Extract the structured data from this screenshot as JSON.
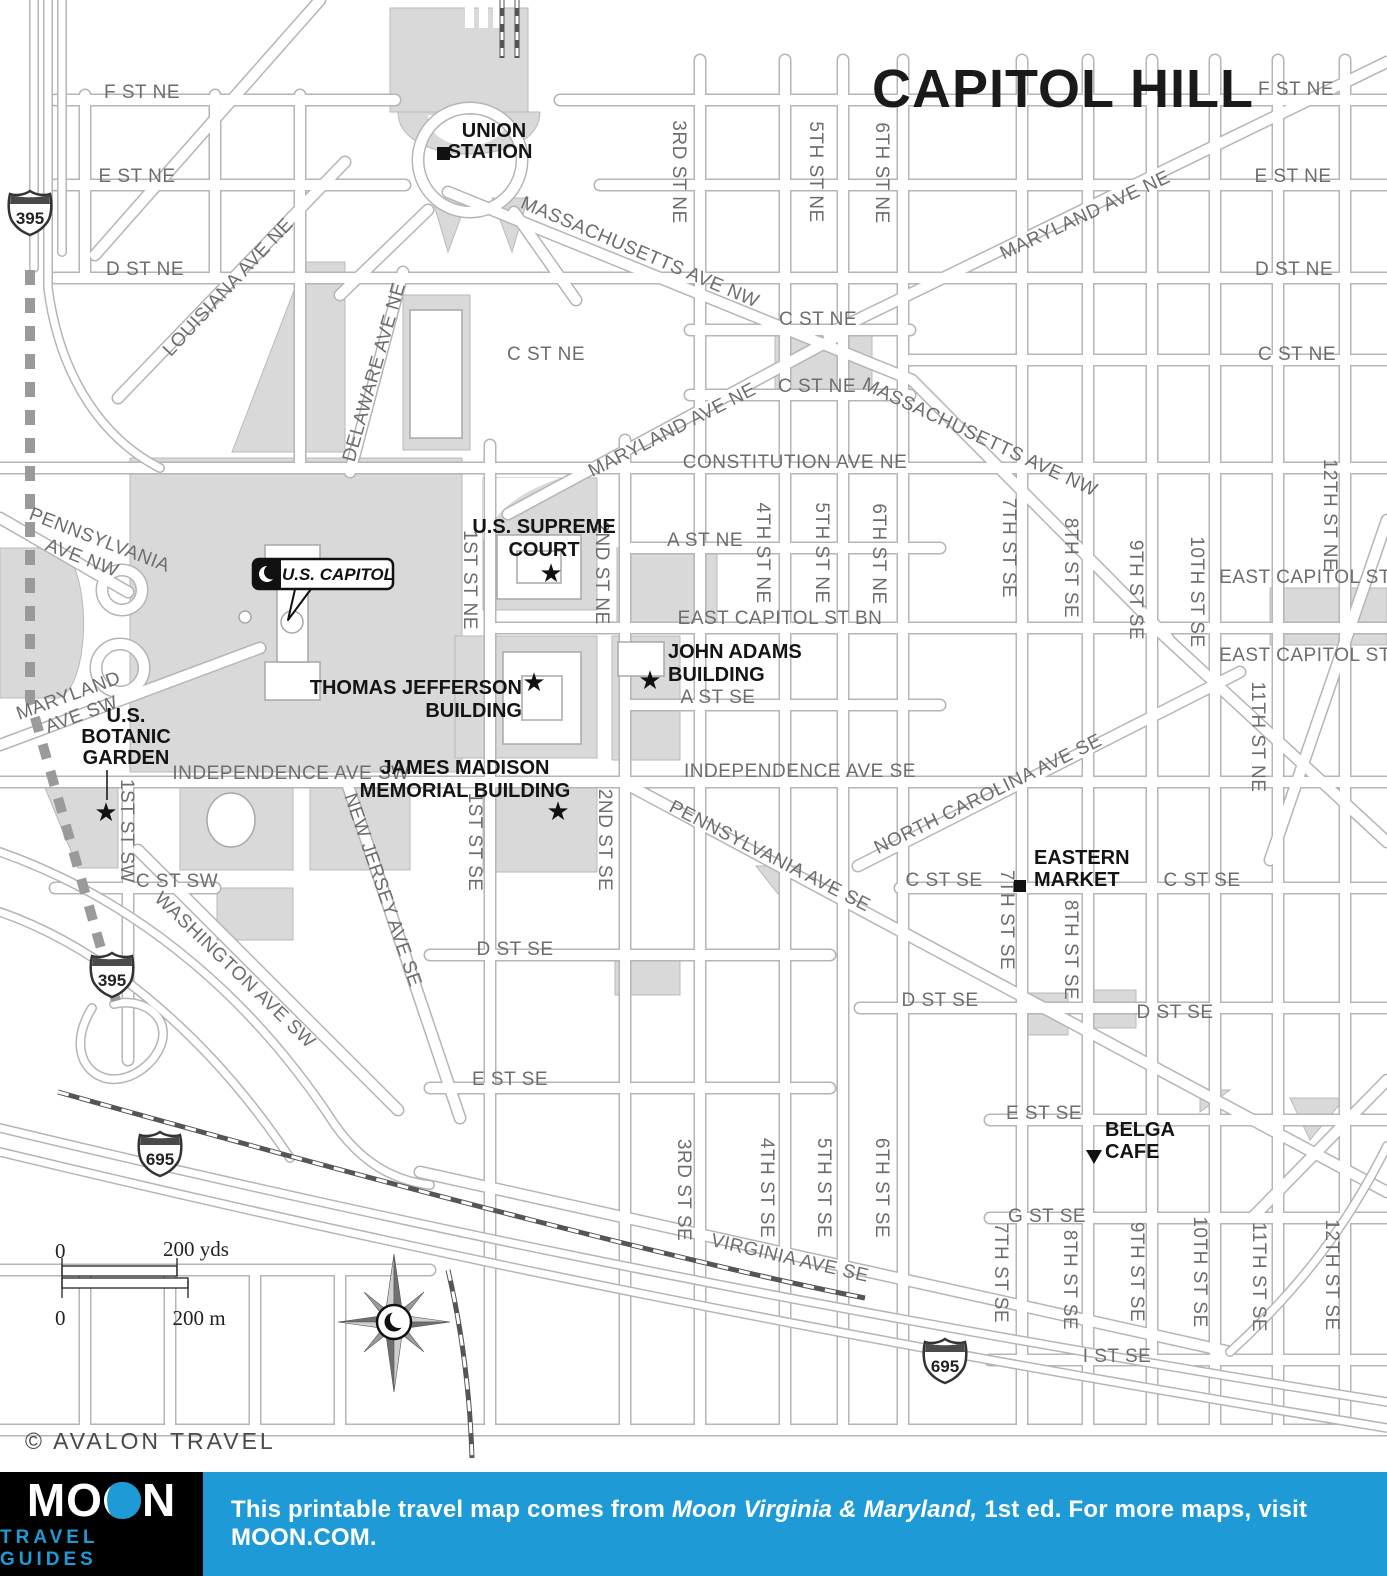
{
  "title": "CAPITOL HILL",
  "copyright": "© AVALON TRAVEL",
  "colors": {
    "accent_blue": "#1e9ad6",
    "park_gray": "#d9d9d9",
    "road_casing_gray": "#b5b5b5",
    "street_label_gray": "#6d6d6d",
    "poi_black": "#141414"
  },
  "map": {
    "icons": {
      "star": "★"
    },
    "streets": {
      "f_st_ne": "F ST NE",
      "e_st_ne": "E ST NE",
      "d_st_ne": "D ST NE",
      "c_st_ne": "C ST NE",
      "constitution_ave_ne": "CONSTITUTION AVE NE",
      "a_st_ne": "A ST NE",
      "east_capitol_st_bn": "EAST CAPITOL ST BN",
      "east_capitol_st": "EAST CAPITOL ST",
      "a_st_se": "A ST SE",
      "independence_ave_sw": "INDEPENDENCE AVE SW",
      "independence_ave_se": "INDEPENDENCE AVE SE",
      "c_st_sw": "C ST SW",
      "c_st_se": "C ST SE",
      "d_st_se": "D ST SE",
      "e_st_se": "E ST SE",
      "g_st_se": "G ST SE",
      "i_st_se": "I ST SE",
      "massachusetts_ave_nw": "MASSACHUSETTS AVE NW",
      "maryland_ave_ne": "MARYLAND AVE NE",
      "maryland_sw_l1": "MARYLAND",
      "maryland_sw_l2": "AVE SW",
      "pennsylvania_l1": "PENNSYLVANIA",
      "pennsylvania_l2": "AVE NW",
      "pennsylvania_ave_se": "PENNSYLVANIA AVE SE",
      "north_carolina_ave_se": "NORTH CAROLINA AVE SE",
      "new_jersey_ave_se": "NEW JERSEY AVE SE",
      "washington_ave_sw": "WASHINGTON AVE SW",
      "louisiana_ave_ne": "LOUISIANA AVE NE",
      "delaware_ave_ne": "DELAWARE AVE NE",
      "virginia_ave_se": "VIRGINIA AVE SE",
      "st_1_ne": "1ST ST NE",
      "st_1_sw": "1ST ST SW",
      "st_1_se": "1ST ST SE",
      "st_2_ne": "2ND ST NE",
      "st_2_se": "2ND ST SE",
      "st_3_ne": "3RD ST NE",
      "st_3_se": "3RD ST SE",
      "st_4_ne": "4TH ST NE",
      "st_4_se": "4TH ST SE",
      "st_5_ne": "5TH ST NE",
      "st_5_se": "5TH ST SE",
      "st_6_ne": "6TH ST NE",
      "st_6_se": "6TH ST SE",
      "st_7_se": "7TH ST SE",
      "st_8_se": "8TH ST SE",
      "st_9_se": "9TH ST SE",
      "st_10_se": "10TH ST SE",
      "st_11_ne": "11TH ST NE",
      "st_11_se": "11TH ST SE",
      "st_12_ne": "12TH ST NE",
      "st_12_se": "12TH ST SE"
    },
    "pois": {
      "union_l1": "UNION",
      "union_l2": "STATION",
      "supreme_l1": "U.S. SUPREME",
      "supreme_l2": "COURT",
      "us_capitol": "U.S. CAPITOL",
      "jefferson_l1": "THOMAS JEFFERSON",
      "jefferson_l2": "BUILDING",
      "adams_l1": "JOHN ADAMS",
      "adams_l2": "BUILDING",
      "madison_l1": "JAMES MADISON",
      "madison_l2": "MEMORIAL BUILDING",
      "botanic_l1": "U.S.",
      "botanic_l2": "BOTANIC",
      "botanic_l3": "GARDEN",
      "eastern_l1": "EASTERN",
      "eastern_l2": "MARKET",
      "belga_l1": "BELGA",
      "belga_l2": "CAFE"
    },
    "shields": {
      "i395": "395",
      "i695": "695"
    },
    "scale": {
      "zero": "0",
      "yds_label": "200 yds",
      "m_label": "200 m"
    }
  },
  "footer": {
    "logo": {
      "m1": "MO",
      "m2": "N",
      "subtitle": "TRAVEL GUIDES"
    },
    "note_pre": "This printable travel map comes from ",
    "note_book": "Moon Virginia & Maryland,",
    "note_post": " 1st ed. For more maps, visit MOON.COM."
  }
}
